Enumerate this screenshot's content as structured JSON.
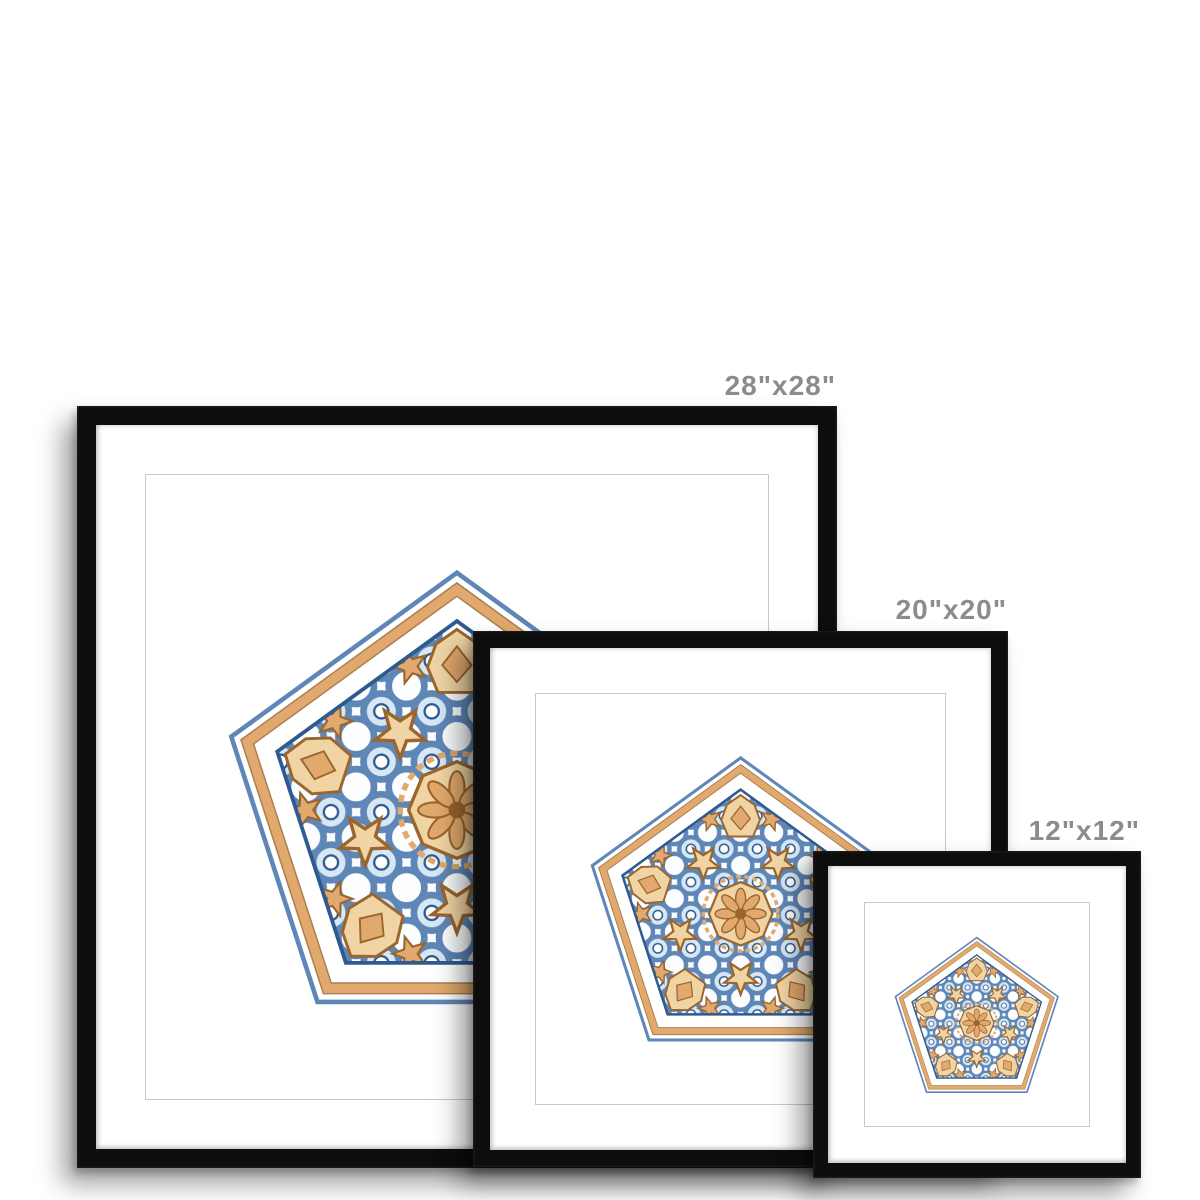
{
  "product": {
    "name": "framed-print-size-comparison",
    "artwork": "blue-and-orange-islamic-geometric-pentagon-watercolor"
  },
  "labels": {
    "size_28": "28\"x28\"",
    "size_20": "20\"x20\"",
    "size_12": "12\"x12\""
  },
  "frames": [
    {
      "id": "frame-28",
      "size_label": "28\"x28\""
    },
    {
      "id": "frame-20",
      "size_label": "20\"x20\""
    },
    {
      "id": "frame-12",
      "size_label": "12\"x12\""
    }
  ],
  "palette": {
    "background": "#ffffff",
    "frame": "#0d0d0d",
    "mat": "#ffffff",
    "edge": "#c9c9c9",
    "label": "#8c8c8c",
    "blue_dark": "#2e5a90",
    "blue": "#5e87b8",
    "blue_light": "#d7e7f3",
    "tan": "#e1a96d",
    "tan_light": "#f0d4a4",
    "brown": "#9a662e"
  }
}
